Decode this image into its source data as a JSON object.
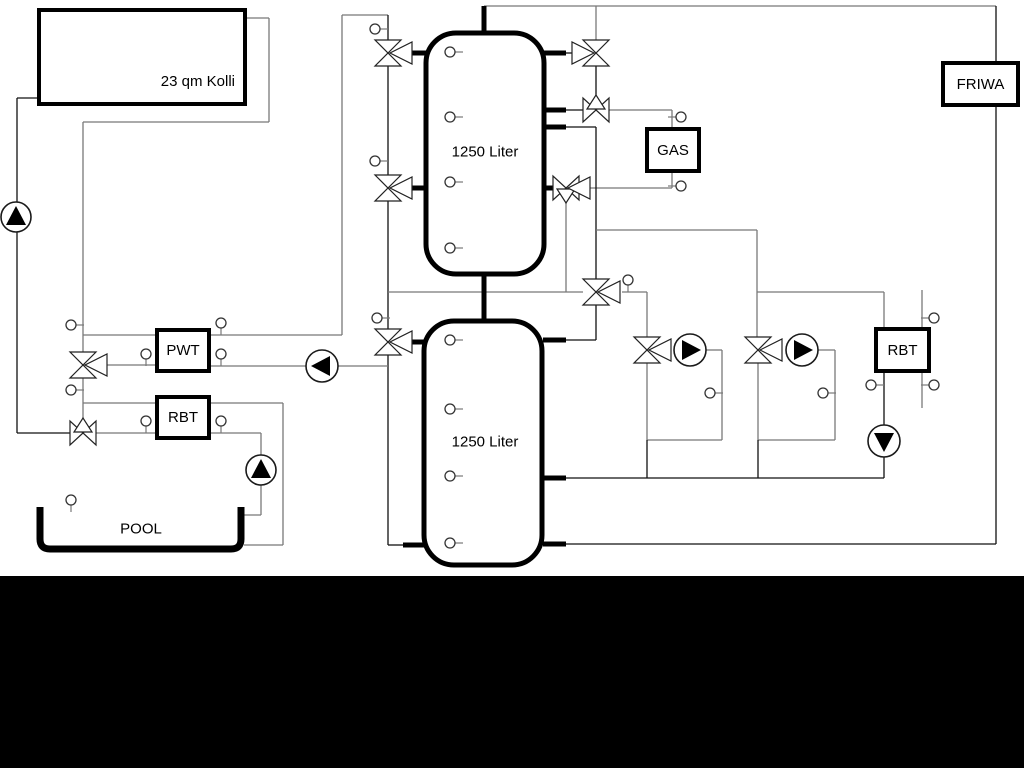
{
  "title": "Heating / pool hydraulic schematic",
  "labels": {
    "collector": "23 qm Kolli",
    "pwt": "PWT",
    "rbt_left": "RBT",
    "gas": "GAS",
    "friwa": "FRIWA",
    "rbt_right": "RBT",
    "pool": "POOL"
  },
  "tanks": [
    {
      "label": "1250 Liter"
    },
    {
      "label": "1250 Liter"
    }
  ],
  "colors": {
    "background": "#ffffff",
    "pipe_gray": "#787878",
    "pipe_black": "#111111",
    "equipment_border": "#000000",
    "pump_fill": "#000000",
    "bottom_bar": "#000000"
  }
}
